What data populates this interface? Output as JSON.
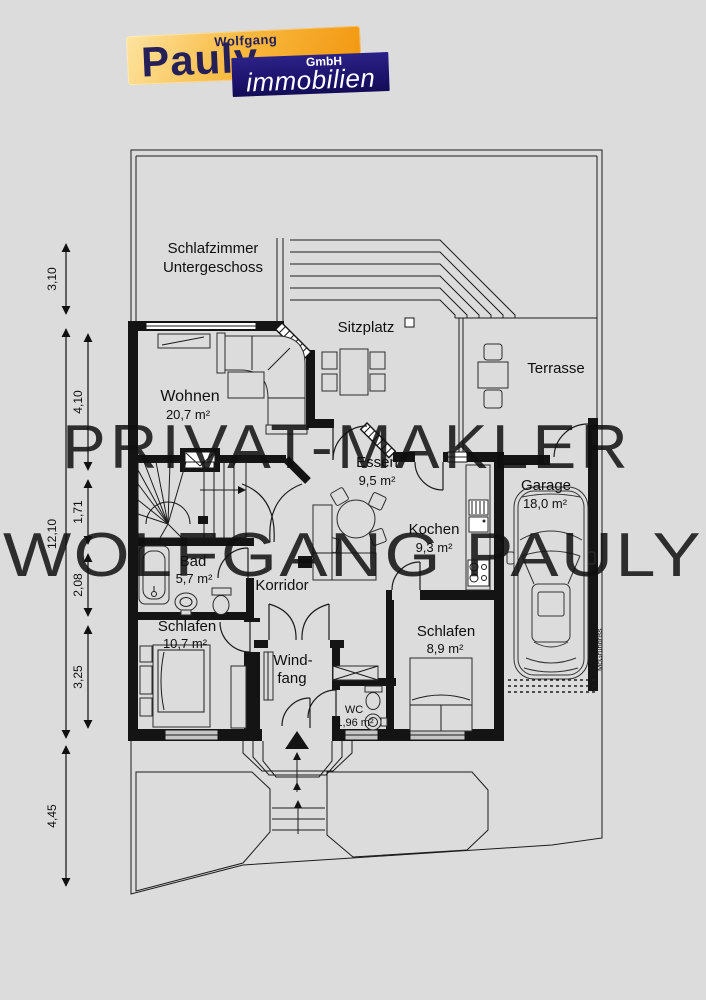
{
  "page": {
    "background": "#dcdcdc",
    "line_color": "#1c1c1c",
    "wall_color": "#141414"
  },
  "logo": {
    "first_name": "Wolfgang",
    "last_name": "Pauly",
    "suffix": "GmbH",
    "tagline": "immobilien",
    "orange": "#f2960f",
    "navy": "#1a1168"
  },
  "watermark": {
    "line1": "PRIVAT-MAKLER",
    "line2": "WOLFGANG PAULY"
  },
  "upper_floor_note": {
    "line1": "Schlafzimmer",
    "line2": "Untergeschoss"
  },
  "rooms": {
    "wohnen": {
      "name": "Wohnen",
      "area": "20,7 m²"
    },
    "sitzplatz": {
      "name": "Sitzplatz"
    },
    "terrasse": {
      "name": "Terrasse"
    },
    "essen": {
      "name": "Essen",
      "area": "9,5 m²"
    },
    "garage": {
      "name": "Garage",
      "area": "18,0 m²"
    },
    "kochen": {
      "name": "Kochen",
      "area": "9,3 m²"
    },
    "bad": {
      "name": "Bad",
      "area": "5,7 m²"
    },
    "korridor": {
      "name": "Korridor"
    },
    "schlafen_left": {
      "name": "Schlafen",
      "area": "10,7 m²"
    },
    "windfang": {
      "name_line1": "Wind-",
      "name_line2": "fang"
    },
    "wc": {
      "name": "WC",
      "area": "1,96 m²"
    },
    "schlafen_right": {
      "name": "Schlafen",
      "area": "8,9 m²"
    }
  },
  "dimensions": {
    "outer": [
      "3,10",
      "12,10",
      "4,45"
    ],
    "inner": [
      "4,10",
      "1,71",
      "2,08",
      "3,25"
    ]
  },
  "credit": "McGrundriss"
}
